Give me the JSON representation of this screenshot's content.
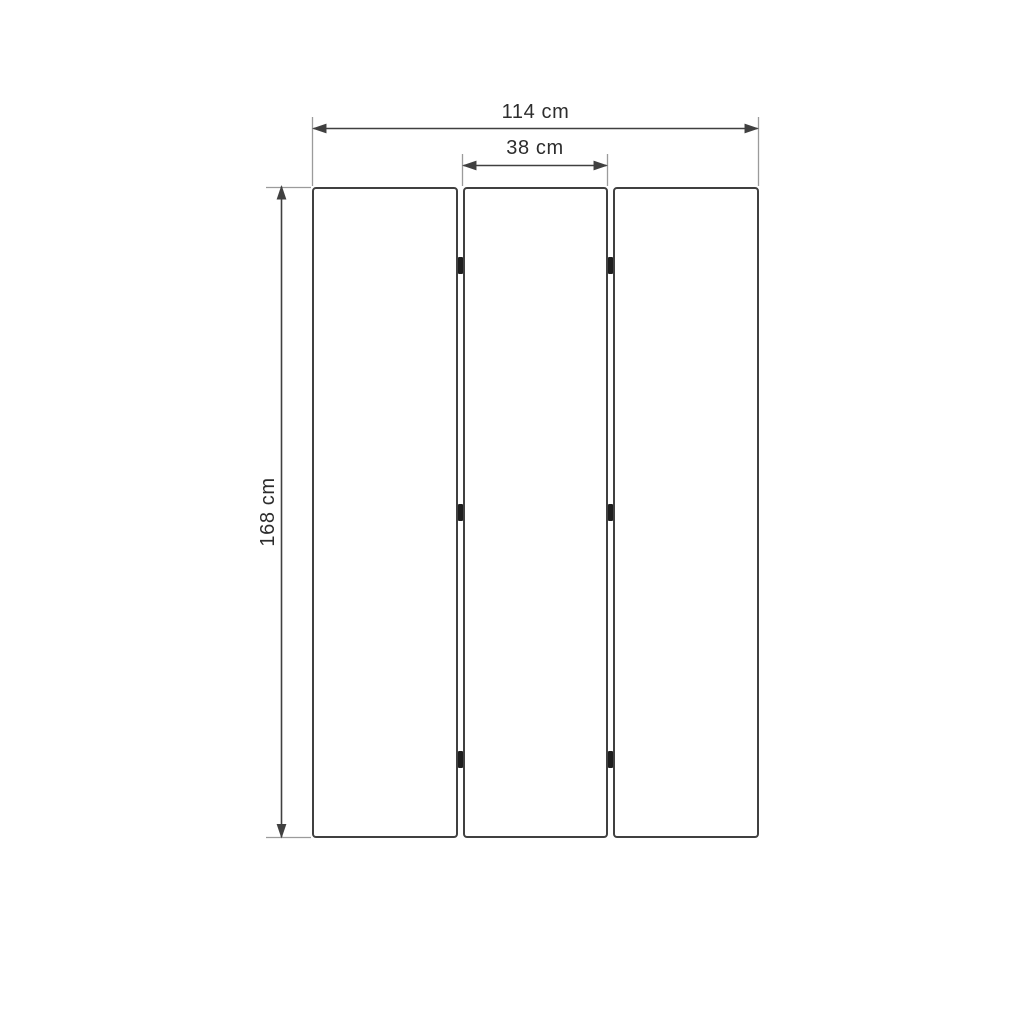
{
  "diagram": {
    "kind": "dimension-drawing",
    "panel_count": 3,
    "hinge_marks": 6,
    "dimensions": {
      "total_width": {
        "label": "114 cm",
        "value": 114,
        "unit": "cm"
      },
      "panel_width": {
        "label": "38 cm",
        "value": 38,
        "unit": "cm"
      },
      "height": {
        "label": "168 cm",
        "value": 168,
        "unit": "cm"
      }
    },
    "colors": {
      "outline": "#404040",
      "extension_line": "#9b9b9b",
      "hinge": "#1e1e1e",
      "text": "#2d2d2d",
      "background": "#ffffff"
    }
  }
}
